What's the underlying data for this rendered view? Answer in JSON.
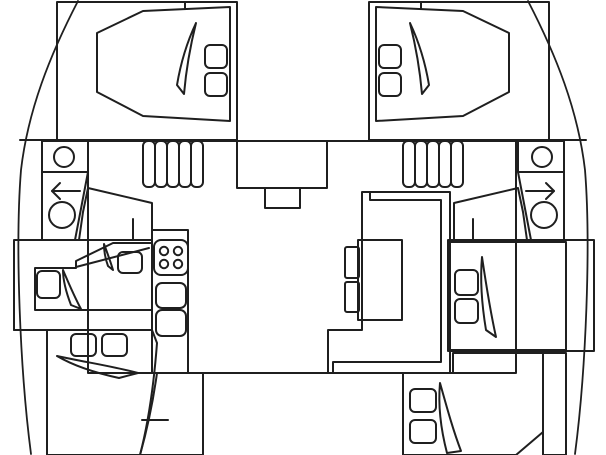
{
  "colors": {
    "background": "#ffffff",
    "outline": "#1f1f1f",
    "deck_white": "#ffffff",
    "hull_interior": "#a6d0dd",
    "bed": "#7fafb3",
    "salon_floor": "#f2d492",
    "bathroom": "#c3da8f",
    "fixture_white": "#ffffff",
    "toilet_seat": "#1f1f1f"
  },
  "layout": {
    "type": "catamaran-floorplan-top-view",
    "cabins": [
      {
        "id": "forward-port",
        "pillows": 2
      },
      {
        "id": "forward-starboard",
        "pillows": 2
      },
      {
        "id": "mid-port",
        "pillows": 2
      },
      {
        "id": "mid-starboard",
        "pillows": 2
      },
      {
        "id": "aft-port",
        "pillows": 2
      },
      {
        "id": "aft-starboard",
        "pillows": 2
      }
    ],
    "bathrooms": [
      {
        "id": "port",
        "fixtures": [
          "sink",
          "arrow-left",
          "toilet"
        ]
      },
      {
        "id": "starboard",
        "fixtures": [
          "sink",
          "arrow-right",
          "toilet"
        ]
      }
    ],
    "galley": {
      "stove_burners": 4,
      "sinks": 2
    },
    "salon": {
      "tables": 1,
      "stools": 2,
      "stair_steps_per_side": 5
    }
  }
}
